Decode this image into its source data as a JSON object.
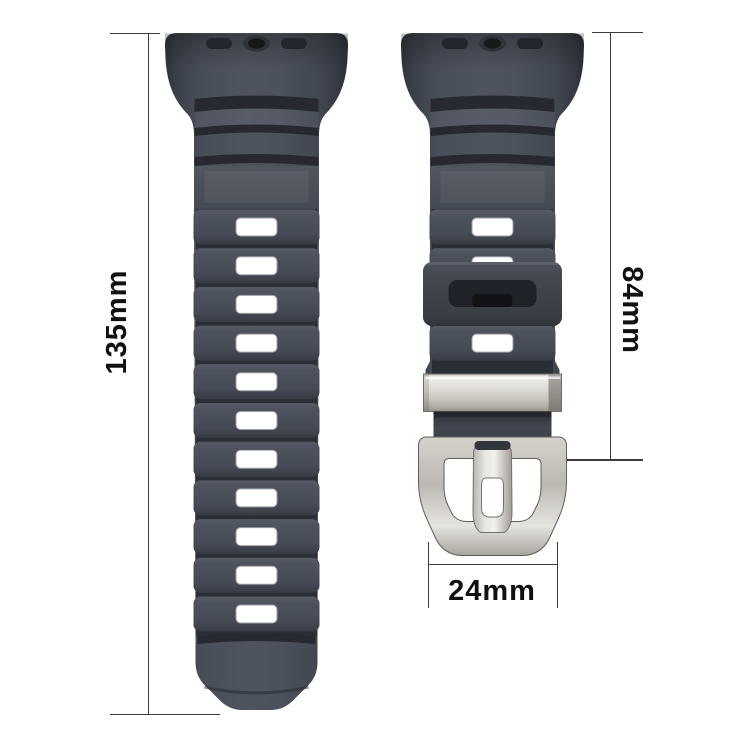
{
  "measurements": {
    "long_strap_length": "135mm",
    "short_strap_length": "84mm",
    "band_width": "24mm"
  },
  "colors": {
    "background": "#ffffff",
    "strap-base": "#4a505a",
    "strap-shadow": "#2a2e35",
    "strap-groove": "#262a30",
    "hole-fill": "#ffffff",
    "hole-border": "#99a0a7",
    "metal-light": "#f1f0ed",
    "metal-mid": "#d2cfc8",
    "metal-dark": "#8f8b84",
    "dim-line": "#3c3c3c",
    "label-text": "#111111"
  }
}
